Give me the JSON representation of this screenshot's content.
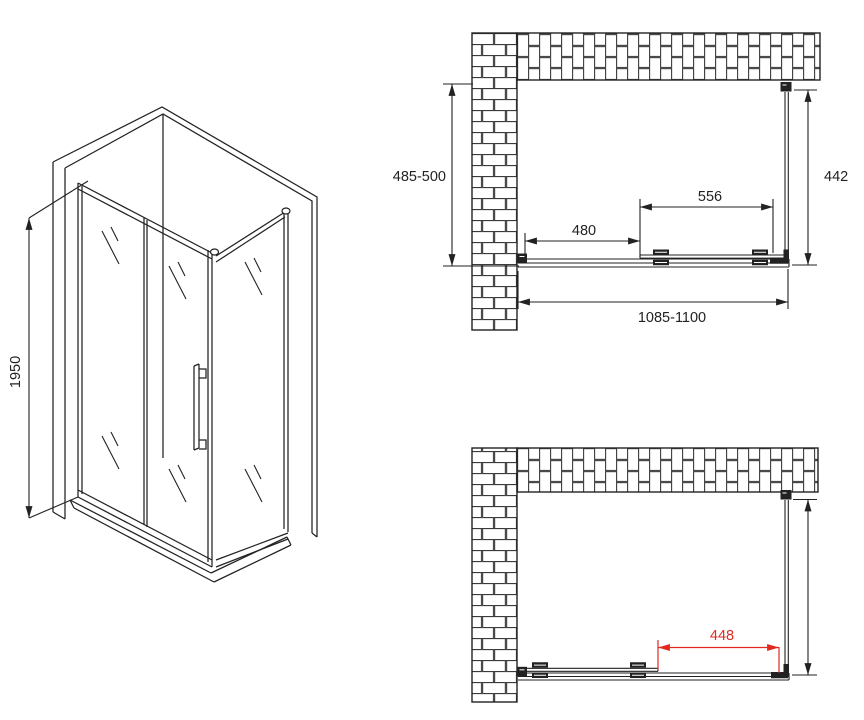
{
  "colors": {
    "line": "#222222",
    "dimension_red": "#e02a20",
    "background": "#ffffff"
  },
  "labels": {
    "iso_height": "1950",
    "plan_top_depth": "485-500",
    "plan_top_side_panel": "442",
    "plan_top_door": "556",
    "plan_top_fixed": "480",
    "plan_top_overall_width": "1085-1100",
    "plan_bottom_opening": "448"
  }
}
